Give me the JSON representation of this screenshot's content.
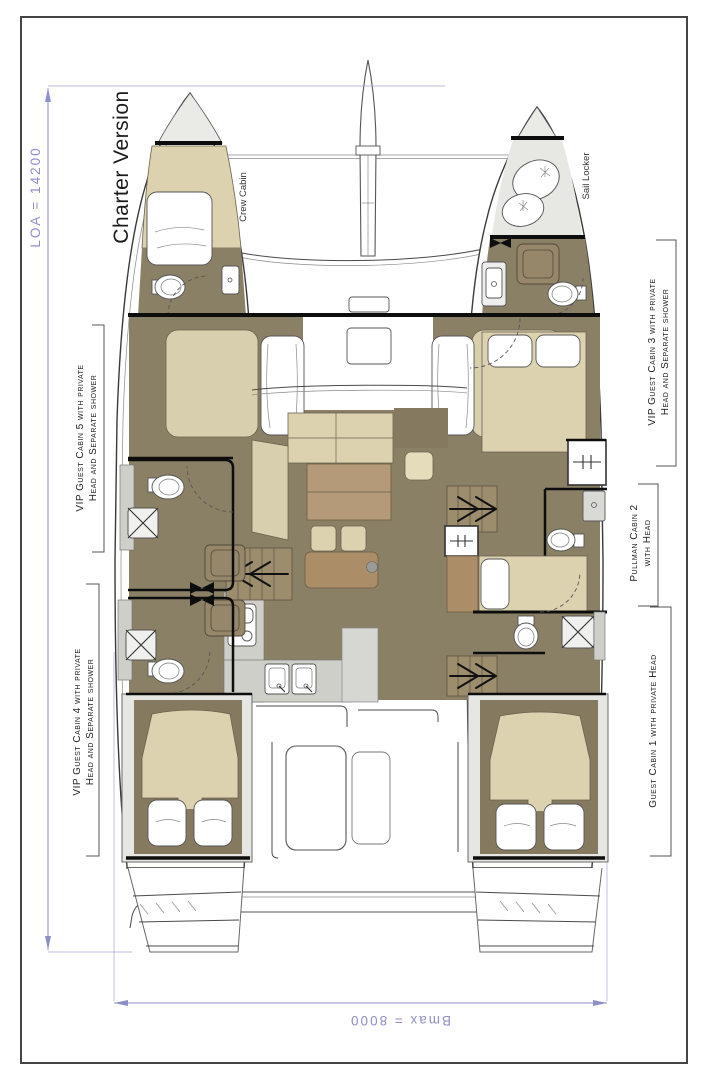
{
  "title": "Charter Version",
  "dimensions": {
    "loa": "LOA = 14200",
    "bmax": "Bmax = 8000"
  },
  "rooms": {
    "crew_cabin": "Crew Cabin",
    "sail_locker": "Sail Locker",
    "cabin5_line1": "VIP Guest Cabin 5 with private",
    "cabin5_line2": "Head and Separate shower",
    "cabin4_line1": "VIP Guest Cabin 4 with private",
    "cabin4_line2": "Head and Separate shower",
    "cabin3_line1": "VIP Guest Cabin 3 with private",
    "cabin3_line2": "Head and Separate shower",
    "cabin2_line1": "Pullman Cabin 2",
    "cabin2_line2": "with Head",
    "cabin1_line1": "Guest Cabin 1 with private Head"
  },
  "colors": {
    "floor": "#8a8066",
    "floor2": "#857a5f",
    "bed": "#dcd2b0",
    "bed2": "#d8cfae",
    "wood": "#b49a79",
    "wood2": "#ab8d68",
    "cab": "#97876a",
    "deck": "#e6e6e2",
    "counter": "#cfcfca",
    "dim": "#8e8ec9",
    "ink": "#1c1c1c"
  }
}
